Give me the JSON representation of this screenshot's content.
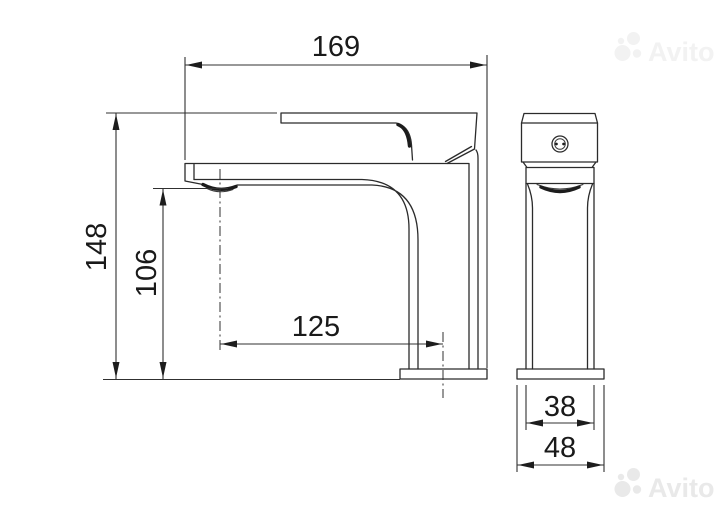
{
  "watermark": {
    "brand": "Avito"
  },
  "drawing": {
    "subject": "basin faucet two-view dimension drawing",
    "dimensions": {
      "overall_length": {
        "value": "169"
      },
      "overall_height": {
        "value": "148"
      },
      "outlet_height": {
        "value": "106"
      },
      "spout_reach": {
        "value": "125"
      },
      "body_width": {
        "value": "38"
      },
      "base_width": {
        "value": "48"
      }
    }
  }
}
